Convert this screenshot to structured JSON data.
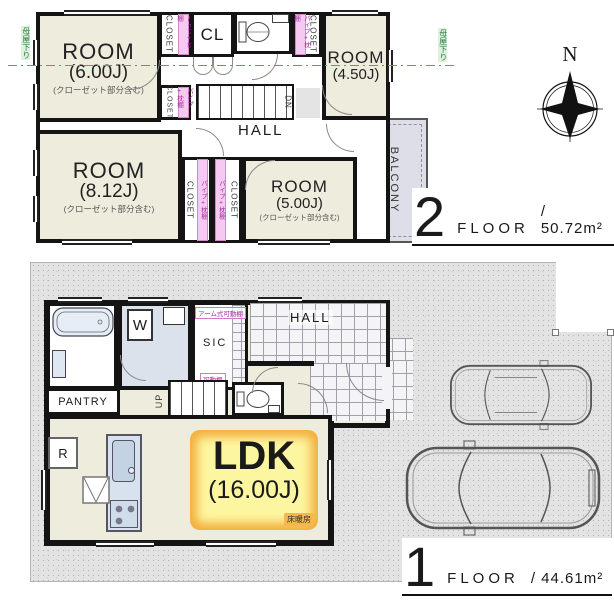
{
  "floor2": {
    "big_number": "2",
    "floor_word": "FLOOR",
    "area": "/ 50.72m²",
    "compass_n": "N",
    "room_600": {
      "title": "ROOM",
      "size": "(6.00J)",
      "note": "(クローゼット部分含む)"
    },
    "room_450": {
      "title": "ROOM",
      "size": "(4.50J)"
    },
    "room_812": {
      "title": "ROOM",
      "size": "(8.12J)",
      "note": "(クローゼット部分含む)"
    },
    "room_500": {
      "title": "ROOM",
      "size": "(5.00J)",
      "note": "(クローゼット部分含む)"
    },
    "cl_label": "CL",
    "hall_label": "HALL",
    "balcony_label": "BALCONY",
    "closet_label": "CLOSET",
    "dn_label": "DN",
    "pipe_shelf_label": "パイプ+枕棚",
    "eaves_label": "母屋下り"
  },
  "floor1": {
    "big_number": "1",
    "floor_word": "FLOOR",
    "area": "/ 44.61m²",
    "ldk": {
      "title": "LDK",
      "size": "(16.00J)"
    },
    "floor_heating_label": "床暖房",
    "hall_label": "HALL",
    "sic_label": "SIC",
    "pantry_label": "PANTRY",
    "washer_label": "W",
    "fridge_label": "R",
    "up_label": "UP",
    "arm_shelf_label": "アーム式可動棚",
    "shelf_label": "可動棚"
  },
  "colors": {
    "room_fill": "#edecdd",
    "wet_fill": "#cfdae6",
    "balcony_fill": "#dedee8",
    "highlight_yellow": "#fdf6a1",
    "highlight_orange": "#f2ae3c",
    "accent_pink": "#a92b9e",
    "accent_green": "#2f7d46"
  }
}
